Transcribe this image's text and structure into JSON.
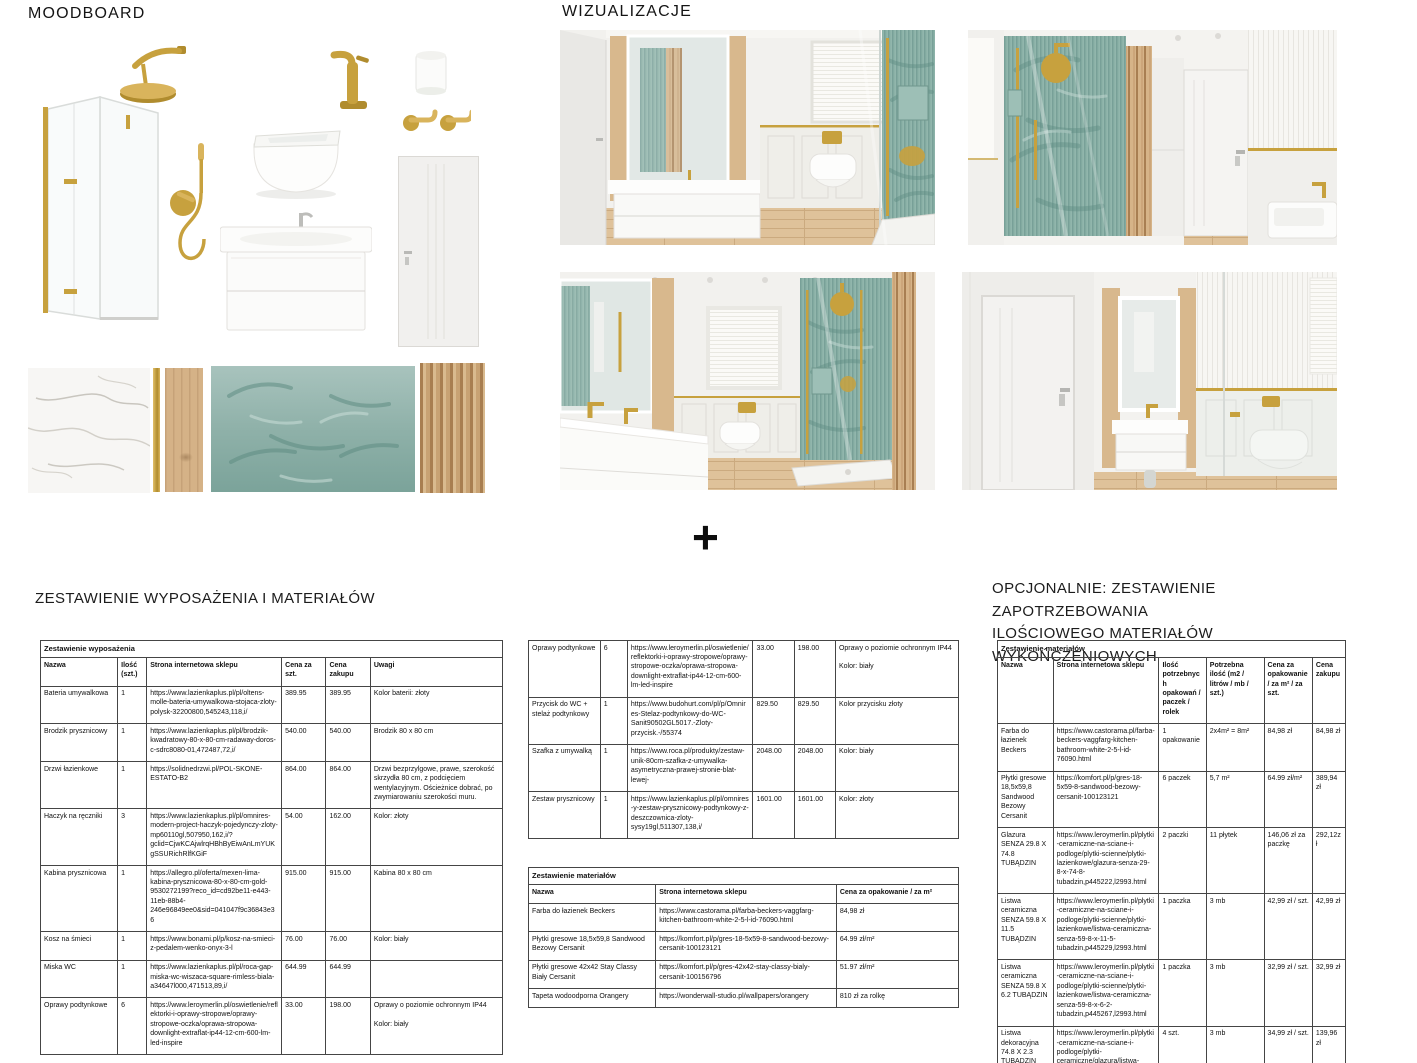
{
  "moodboard": {
    "title": "MOODBOARD",
    "items": [
      "shower-cabin",
      "rain-shower-head",
      "hand-shower-and-mixer",
      "wall-hung-toilet",
      "basin-faucet",
      "ceiling-light",
      "towel-hooks",
      "vanity-with-basin",
      "interior-door",
      "marble-swatch",
      "gold-strip-swatch",
      "wood-swatch",
      "tropical-wallpaper-swatch",
      "wood-slats-swatch"
    ]
  },
  "visualizations": {
    "title": "WIZUALIZACJE",
    "scenes": [
      "vanity-mirror-toilet-shower-view",
      "shower-wall-door-basin-view",
      "double-vanity-window-shower-view",
      "door-vanity-toilet-partition-view"
    ]
  },
  "divider": {
    "plus": "+"
  },
  "sections": {
    "equipment_heading": "ZESTAWIENIE WYPOSAŻENIA I MATERIAŁÓW",
    "optional_heading": "OPCJONALNIE: ZESTAWIENIE ZAPOTRZEBOWANIA\nILOŚCIOWEGO MATERIAŁÓW WYKOŃCZENIOWYCH"
  },
  "palette": {
    "gold": "#c7a13e",
    "teal_wall": "#87aea4",
    "wood": "#d6b488",
    "floor_wood": "#dfc29a",
    "text": "#1a1a1a"
  },
  "equipment_table": {
    "title": "Zestawienie wyposażenia",
    "columns": [
      "Nazwa",
      "Ilość (szt.)",
      "Strona internetowa sklepu",
      "Cena za szt.",
      "Cena zakupu",
      "Uwagi"
    ],
    "widths": [
      16.7,
      6.3,
      29.2,
      9.6,
      9.6,
      28.6
    ],
    "rows": [
      [
        "Bateria umywalkowa",
        "1",
        "https://www.lazienkaplus.pl/pl/oltens-molle-bateria-umywalkowa-stojaca-zloty-polysk-32200800,545243,118,i/",
        "389.95",
        "389.95",
        "Kolor baterii: złoty"
      ],
      [
        "Brodzik prysznicowy",
        "1",
        "https://www.lazienkaplus.pl/pl/brodzik-kwadratowy-80-x-80-cm-radaway-doros-c-sdrc8080-01,472487,72,i/",
        "540.00",
        "540.00",
        "Brodzik 80 x 80 cm"
      ],
      [
        "Drzwi łazienkowe",
        "1",
        "https://solidnedrzwi.pl/POL-SKONE-ESTATO-B2",
        "864.00",
        "864.00",
        "Drzwi bezprzylgowe, prawe, szerokość skrzydła 80 cm, z podcięciem wentylacyjnym. Ościeżnice dobrać, po zwymiarowaniu szerokości muru."
      ],
      [
        "Haczyk na ręczniki",
        "3",
        "https://www.lazienkaplus.pl/pl/omnires-modern-project-haczyk-pojedynczy-zloty-mp60110gl,507950,162,i/?gclid=CjwKCAjwlrqHBhByEiwAnLmYUKgSSURichRlfKGiF",
        "54.00",
        "162.00",
        "Kolor: złoty"
      ],
      [
        "Kabina prysznicowa",
        "1",
        "https://allegro.pl/oferta/mexen-lima-kabina-prysznicowa-80-x-80-cm-gold-9530272199?reco_id=cd92be11-e443-11eb-88b4-246e96849ee0&sid=041047f9c36843e36",
        "915.00",
        "915.00",
        "Kabina 80 x 80 cm"
      ],
      [
        "Kosz na śmieci",
        "1",
        "https://www.bonami.pl/p/kosz-na-smieci-z-pedalem-wenko-onyx-3-l",
        "76.00",
        "76.00",
        "Kolor: biały"
      ],
      [
        "Miska WC",
        "1",
        "https://www.lazienkaplus.pl/pl/roca-gap-miska-wc-wiszaca-square-rimless-biala-a34647l000,471513,89,i/",
        "644.99",
        "644.99",
        ""
      ],
      [
        "Oprawy podtynkowe",
        "6",
        "https://www.leroymerlin.pl/oswietlenie/reflektorki-i-oprawy-stropowe/oprawy-stropowe-oczka/oprawa-stropowa-downlight-extraflat-ip44-12-cm-600-lm-led-inspire",
        "33.00",
        "198.00",
        "Oprawy o poziomie ochronnym IP44\n\nKolor: biały"
      ]
    ]
  },
  "equipment_table_continued": {
    "widths": [
      16.7,
      6.3,
      29.2,
      9.6,
      9.6,
      28.6
    ],
    "rows": [
      [
        "Oprawy podtynkowe",
        "6",
        "https://www.leroymerlin.pl/oswietlenie/reflektorki-i-oprawy-stropowe/oprawy-stropowe-oczka/oprawa-stropowa-downlight-extraflat-ip44-12-cm-600-lm-led-inspire",
        "33.00",
        "198.00",
        "Oprawy o poziomie ochronnym IP44\n\nKolor: biały"
      ],
      [
        "Przycisk do WC + stelaż podtynkowy",
        "1",
        "https://www.budohurt.com/pl/p/Omnires-Stelaz-podtynkowy-do-WC-Sanit90502GL5017.-Zloty-przycisk.-/55374",
        "829.50",
        "829.50",
        "Kolor przycisku złoty"
      ],
      [
        "Szafka z umywalką",
        "1",
        "https://www.roca.pl/produkty/zestaw-unik-80cm-szafka-z-umywalka-asymetryczna-prawej-stronie-blat-lewej-",
        "2048.00",
        "2048.00",
        "Kolor: biały"
      ],
      [
        "Zestaw prysznicowy",
        "1",
        "https://www.lazienkaplus.pl/pl/omnires-y-zestaw-prysznicowy-podtynkowy-z-deszczownica-zloty-sysy19gl,511307,138,i/",
        "1601.00",
        "1601.00",
        "Kolor: złoty"
      ]
    ]
  },
  "materials_table": {
    "title": "Zestawienie materiałów",
    "columns": [
      "Nazwa",
      "Strona internetowa sklepu",
      "Cena za opakowanie / za m²"
    ],
    "widths": [
      29.6,
      42,
      28.4
    ],
    "rows": [
      [
        "Farba do łazienek Beckers",
        "https://www.castorama.pl/farba-beckers-vaggfarg-kitchen-bathroom-white-2-5-l-id-76090.html",
        "84,98 zł"
      ],
      [
        "Płytki gresowe 18,5x59,8 Sandwood Bezowy Cersanit",
        "https://komfort.pl/p/gres-18-5x59-8-sandwood-bezowy-cersanit-100123121",
        "64.99 zł/m²"
      ],
      [
        "Płytki gresowe 42x42 Stay Classy Biały Cersanit",
        "https://komfort.pl/p/gres-42x42-stay-classy-bialy-cersanit-100156796",
        "51.97 zł/m²"
      ],
      [
        "Tapeta wodoodporna Orangery",
        "https://wonderwall-studio.pl/wallpapers/orangery",
        "810 zł za rolkę"
      ]
    ]
  },
  "materials_quantity_table": {
    "title": "Zestawienie materiałów",
    "columns": [
      "Nazwa",
      "Strona internetowa sklepu",
      "Ilość potrzebnych opakowań / paczek / rolek",
      "Potrzebna ilość (m2 / litrów / mb / szt.)",
      "Cena za opakowanie / za m² / za szt.",
      "Cena zakupu"
    ],
    "widths": [
      16,
      30.4,
      13.6,
      16.6,
      13.9,
      9.5
    ],
    "rows": [
      [
        "Farba do łazienek Beckers",
        "https://www.castorama.pl/farba-beckers-vaggfarg-kitchen-bathroom-white-2-5-l-id-76090.html",
        "1 opakowanie",
        "2x4m² = 8m²",
        "84,98 zł",
        "84,98 zł"
      ],
      [
        "Płytki gresowe 18,5x59,8 Sandwood Bezowy Cersanit",
        "https://komfort.pl/p/gres-18-5x59-8-sandwood-bezowy-cersanit-100123121",
        "6 paczek",
        "5,7 m²",
        "64.99 zł/m²",
        "389,94 zł"
      ],
      [
        "Glazura SENZA 29.8 X 74.8 TUBĄDZIN",
        "https://www.leroymerlin.pl/plytki-ceramiczne-na-sciane-i-podloge/plytki-scienne/plytki-lazienkowe/glazura-senza-29-8-x-74-8-tubadzin,p445222,l2993.html",
        "2 paczki",
        "11 płytek",
        "146,06 zł za paczkę",
        "292,12zł"
      ],
      [
        "Listwa ceramiczna SENZA 59.8 X 11.5 TUBĄDZIN",
        "https://www.leroymerlin.pl/plytki-ceramiczne-na-sciane-i-podloge/plytki-scienne/plytki-lazienkowe/listwa-ceramiczna-senza-59-8-x-11-5-tubadzin,p445229,l2993.html",
        "1 paczka",
        "3 mb",
        "42,99 zł / szt.",
        "42,99 zł"
      ],
      [
        "Listwa ceramiczna SENZA 59.8 X 6.2 TUBĄDZIN",
        "https://www.leroymerlin.pl/plytki-ceramiczne-na-sciane-i-podloge/plytki-scienne/plytki-lazienkowe/listwa-ceramiczna-senza-59-8-x-6-2-tubadzin,p445267,l2993.html",
        "1 paczka",
        "3 mb",
        "32,99 zł / szt.",
        "32,99 zł"
      ],
      [
        "Listwa dekoracyjna 74.8 X 2.3 TUBĄDZIN ARTE\n\nZłota",
        "https://www.leroymerlin.pl/plytki-ceramiczne-na-sciane-i-podloge/plytki-ceramiczne/glazura/listwa-dekoracyjna-74-8-x-2-3-tubadzin-arte,p462535,l230.html",
        "4 szt.",
        "3 mb",
        "34,99 zł / szt.",
        "139,96 zł"
      ]
    ]
  }
}
